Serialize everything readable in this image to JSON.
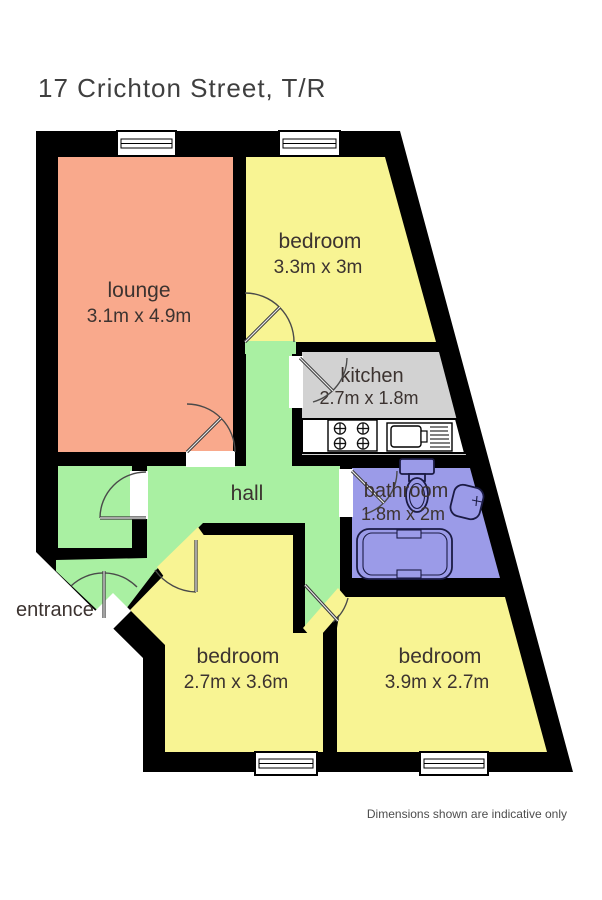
{
  "title": "17 Crichton Street, T/R",
  "footer": "Dimensions shown are indicative only",
  "rooms": {
    "lounge": {
      "name": "lounge",
      "dims": "3.1m x 4.9m",
      "color": "#f9a98c"
    },
    "bedroom_top": {
      "name": "bedroom",
      "dims": "3.3m x 3m",
      "color": "#f8f493"
    },
    "kitchen": {
      "name": "kitchen",
      "dims": "2.7m x 1.8m",
      "color": "#d2d2d2"
    },
    "bathroom": {
      "name": "bathroom",
      "dims": "1.8m x 2m",
      "color": "#9b9be8"
    },
    "hall": {
      "name": "hall",
      "color": "#a9f0a2"
    },
    "cupboard": {
      "color": "#a9f0a2"
    },
    "entrance": {
      "name": "entrance"
    },
    "bedroom_left": {
      "name": "bedroom",
      "dims": "2.7m x 3.6m",
      "color": "#f8f493"
    },
    "bedroom_right": {
      "name": "bedroom",
      "dims": "3.9m x 2.7m",
      "color": "#f8f493"
    }
  },
  "colors": {
    "wall": "#000000",
    "label_text": "#3c3330",
    "title_text": "#3f3f3f",
    "footer_text": "#4d4d4d",
    "window": "#ffffff",
    "threshold": "#ffffff",
    "fixture_outline": "#1b1b44"
  }
}
